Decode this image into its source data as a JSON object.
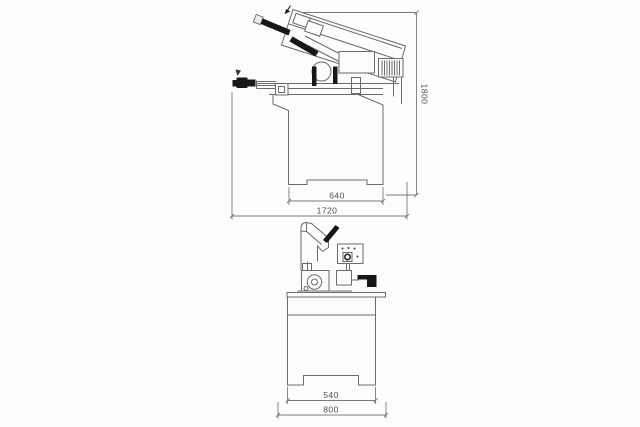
{
  "title": "Band saw machine technical drawing",
  "palette": {
    "background": "#fcfcfc",
    "line": "#6b6b6b",
    "ink_black": "#171717",
    "dimension_text": "#4f4f4f"
  },
  "drawing": {
    "side_view": {
      "name": "side-elevation",
      "dimensions": {
        "overall_height": "1800",
        "base_width": "640",
        "overall_length": "1720"
      }
    },
    "front_view": {
      "name": "front-elevation",
      "dimensions": {
        "base_width": "540",
        "overall_width": "800"
      }
    }
  }
}
